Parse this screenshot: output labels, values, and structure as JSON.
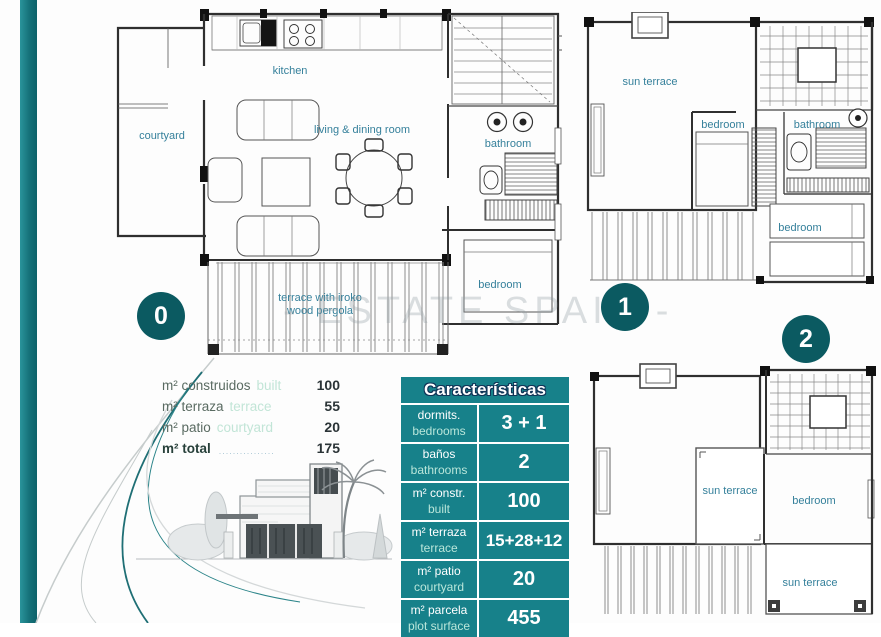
{
  "colors": {
    "accent": "#17818a",
    "badge": "#0b5a61",
    "room_label": "#35809b"
  },
  "watermark": "- ESTATE SPAIN -",
  "floors": {
    "f0": {
      "badge": "0",
      "labels": {
        "kitchen": "kitchen",
        "courtyard": "courtyard",
        "living": "living & dining room",
        "bathroom": "bathroom",
        "bedroom": "bedroom",
        "terrace_l1": "terrace with iroko",
        "terrace_l2": "wood pergola"
      }
    },
    "f1": {
      "badge": "1",
      "labels": {
        "sun_terrace": "sun terrace",
        "bedroom": "bedroom",
        "bathroom": "bathroom",
        "bedroom2": "bedroom"
      }
    },
    "f2": {
      "badge": "2",
      "labels": {
        "sun_terrace": "sun terrace",
        "bedroom": "bedroom",
        "sun_terrace2": "sun terrace"
      }
    }
  },
  "summary": {
    "rows": [
      {
        "es": "m² construidos",
        "en": "built",
        "value": "100"
      },
      {
        "es": "m² terraza",
        "en": "terrace",
        "value": "55"
      },
      {
        "es": "m² patio",
        "en": "courtyard",
        "value": "20"
      }
    ],
    "total": {
      "es": "m² total",
      "leader": "................",
      "value": "175"
    }
  },
  "table": {
    "title": "Características",
    "rows": [
      {
        "es": "dormits.",
        "en": "bedrooms",
        "value": "3 + 1"
      },
      {
        "es": "baños",
        "en": "bathrooms",
        "value": "2"
      },
      {
        "es": "m² constr.",
        "en": "built",
        "value": "100"
      },
      {
        "es": "m² terraza",
        "en": "terrace",
        "value": "15+28+12"
      },
      {
        "es": "m² patio",
        "en": "courtyard",
        "value": "20"
      },
      {
        "es": "m² parcela",
        "en": "plot surface",
        "value": "455"
      }
    ]
  }
}
